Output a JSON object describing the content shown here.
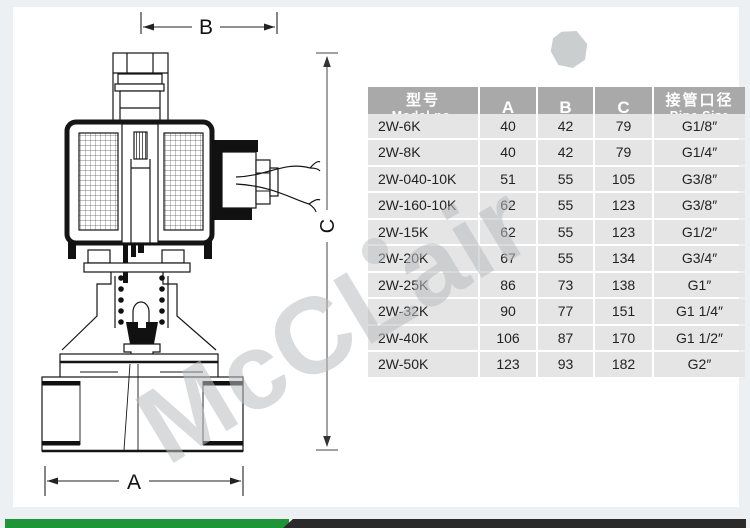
{
  "colors": {
    "page_band": "#edf0f2",
    "content_bg": "#ffffff",
    "header_bg": "#a9a9a9",
    "row_bg": "#e5e5e5",
    "banner_green": "#1e9638",
    "banner_dark": "#2a2a2a",
    "watermark_gray": "#b9bdbf"
  },
  "diagram": {
    "dim_b": "B",
    "dim_c": "C",
    "dim_a": "A"
  },
  "watermark": {
    "text": "McCLair"
  },
  "table": {
    "header": {
      "model_cn": "型号",
      "model_en": "Model no.",
      "col_a": "A",
      "col_b": "B",
      "col_c": "C",
      "pipe_cn": "接管口径",
      "pipe_en": "Pipe Size"
    },
    "rows": [
      {
        "model": "2W-6K",
        "a": "40",
        "b": "42",
        "c": "79",
        "pipe": "G1/8″"
      },
      {
        "model": "2W-8K",
        "a": "40",
        "b": "42",
        "c": "79",
        "pipe": "G1/4″"
      },
      {
        "model": "2W-040-10K",
        "a": "51",
        "b": "55",
        "c": "105",
        "pipe": "G3/8″"
      },
      {
        "model": "2W-160-10K",
        "a": "62",
        "b": "55",
        "c": "123",
        "pipe": "G3/8″"
      },
      {
        "model": "2W-15K",
        "a": "62",
        "b": "55",
        "c": "123",
        "pipe": "G1/2″"
      },
      {
        "model": "2W-20K",
        "a": "67",
        "b": "55",
        "c": "134",
        "pipe": "G3/4″"
      },
      {
        "model": "2W-25K",
        "a": "86",
        "b": "73",
        "c": "138",
        "pipe": "G1″"
      },
      {
        "model": "2W-32K",
        "a": "90",
        "b": "77",
        "c": "151",
        "pipe": "G1 1/4″"
      },
      {
        "model": "2W-40K",
        "a": "106",
        "b": "87",
        "c": "170",
        "pipe": "G1 1/2″"
      },
      {
        "model": "2W-50K",
        "a": "123",
        "b": "93",
        "c": "182",
        "pipe": "G2″"
      }
    ]
  }
}
